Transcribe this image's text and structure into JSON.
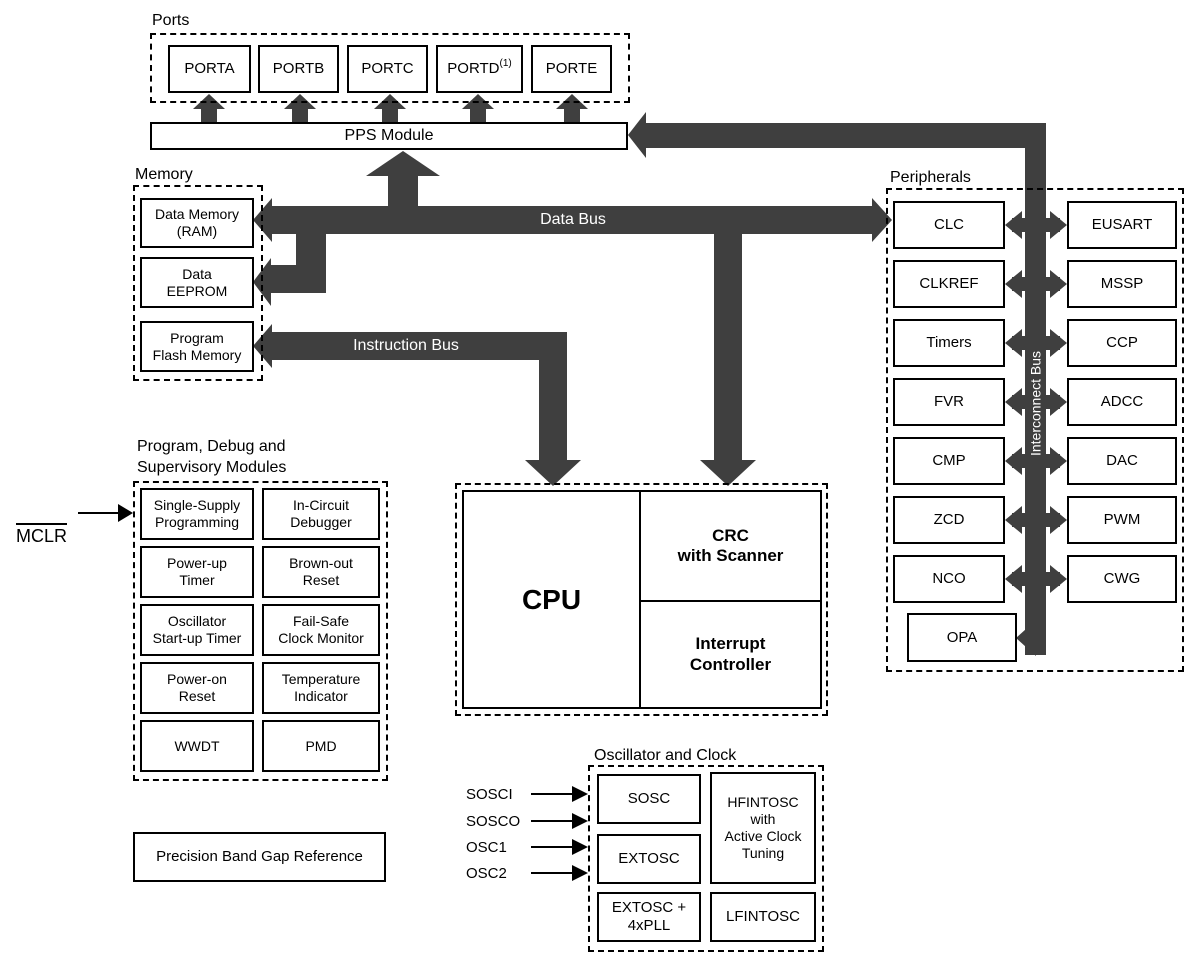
{
  "colors": {
    "bus": "#3f3f3f",
    "line": "#000000",
    "background": "#ffffff"
  },
  "ports": {
    "section_label": "Ports",
    "items": [
      "PORTA",
      "PORTB",
      "PORTC",
      "PORTD",
      "PORTE"
    ],
    "portd_note": "(1)"
  },
  "pps": {
    "label": "PPS Module"
  },
  "memory": {
    "section_label": "Memory",
    "items": [
      "Data Memory\n(RAM)",
      "Data\nEEPROM",
      "Program\nFlash Memory"
    ]
  },
  "buses": {
    "data": "Data Bus",
    "instruction": "Instruction Bus",
    "interconnect": "Interconnect Bus"
  },
  "peripherals": {
    "section_label": "Peripherals",
    "left": [
      "CLC",
      "CLKREF",
      "Timers",
      "FVR",
      "CMP",
      "ZCD",
      "NCO"
    ],
    "right": [
      "EUSART",
      "MSSP",
      "CCP",
      "ADCC",
      "DAC",
      "PWM",
      "CWG"
    ],
    "opa": "OPA"
  },
  "cpu": {
    "label": "CPU",
    "crc": "CRC\nwith Scanner",
    "interrupt": "Interrupt\nController"
  },
  "debug": {
    "section_label": "Program, Debug and\nSupervisory Modules",
    "items": [
      "Single-Supply\nProgramming",
      "In-Circuit\nDebugger",
      "Power-up\nTimer",
      "Brown-out\nReset",
      "Oscillator\nStart-up Timer",
      "Fail-Safe\nClock Monitor",
      "Power-on\nReset",
      "Temperature\nIndicator",
      "WWDT",
      "PMD"
    ]
  },
  "mclr": {
    "label": "MCLR"
  },
  "bandgap": {
    "label": "Precision Band Gap Reference"
  },
  "osc": {
    "section_label": "Oscillator and Clock",
    "pins": [
      "SOSCI",
      "SOSCO",
      "OSC1",
      "OSC2"
    ],
    "sosc": "SOSC",
    "extosc": "EXTOSC",
    "extosc_pll": "EXTOSC +\n4xPLL",
    "hfintosc": "HFINTOSC\nwith\nActive Clock\nTuning",
    "lfintosc": "LFINTOSC"
  }
}
